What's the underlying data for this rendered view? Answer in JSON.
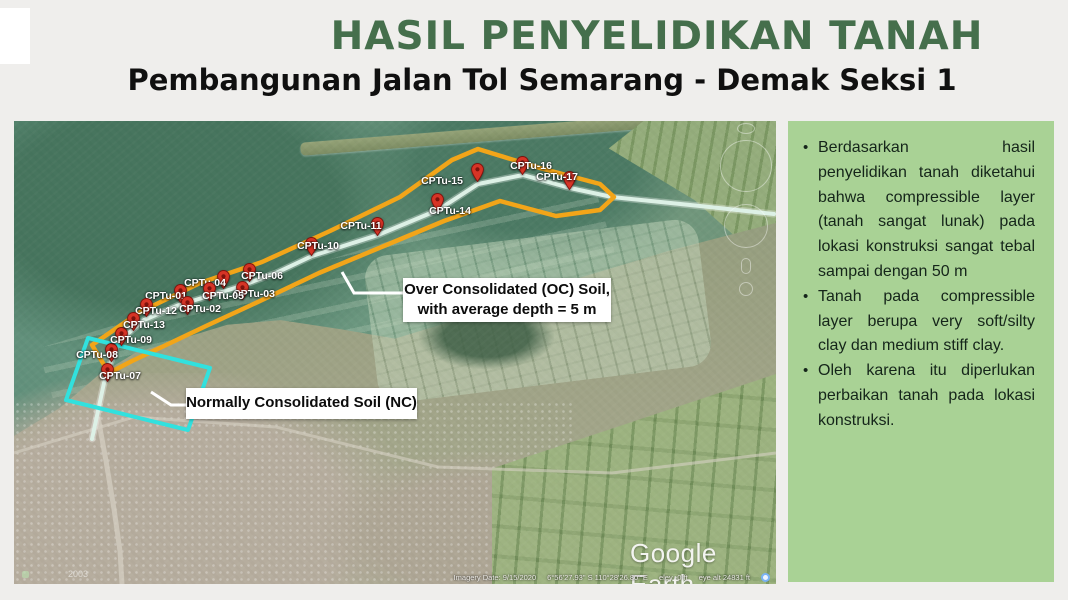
{
  "header": {
    "title": "HASIL PENYELIDIKAN TANAH",
    "subtitle": "Pembangunan Jalan Tol Semarang - Demak Seksi 1"
  },
  "panel": {
    "bullets": [
      "Berdasarkan hasil penyelidikan tanah diketahui bahwa compressible layer (tanah sangat lunak) pada lokasi konstruksi sangat tebal sampai dengan 50 m",
      "Tanah pada compressible layer berupa very soft/silty clay dan medium stiff clay.",
      "Oleh karena itu diperlukan perbaikan tanah pada lokasi konstruksi."
    ]
  },
  "map": {
    "oc_label": [
      "Over Consolidated (OC) Soil,",
      "with average depth = 5 m"
    ],
    "nc_label": "Normally Consolidated Soil (NC)",
    "watermark": "Google Earth",
    "status": {
      "imagery_date": "Imagery Date: 9/15/2020",
      "coordinates": "6°56'27.93\" S  110°28'26.80\" E",
      "elevation": "elev  -0 ft",
      "eye_altitude": "eye alt  24831 ft"
    },
    "history_year": "2003",
    "cpt_points": [
      {
        "id": "CPTu-01",
        "pin": [
          166,
          181
        ],
        "label": [
          152,
          175
        ]
      },
      {
        "id": "CPTu-02",
        "pin": [
          173,
          193
        ],
        "label": [
          186,
          188
        ]
      },
      {
        "id": "CPTu-03",
        "pin": [
          228,
          178
        ],
        "label": [
          240,
          173
        ]
      },
      {
        "id": "CPTu-04",
        "pin": [
          209,
          167
        ],
        "label": [
          191,
          162
        ]
      },
      {
        "id": "CPTu-05",
        "pin": [
          195,
          179
        ],
        "label": [
          209,
          175
        ]
      },
      {
        "id": "CPTu-06",
        "pin": [
          235,
          160
        ],
        "label": [
          248,
          155
        ]
      },
      {
        "id": "CPTu-07",
        "pin": [
          93,
          260
        ],
        "label": [
          106,
          255
        ]
      },
      {
        "id": "CPTu-08",
        "pin": [
          97,
          240
        ],
        "label": [
          83,
          234
        ]
      },
      {
        "id": "CPTu-09",
        "pin": [
          107,
          224
        ],
        "label": [
          117,
          219
        ]
      },
      {
        "id": "CPTu-12",
        "pin": [
          132,
          195
        ],
        "label": [
          142,
          190
        ]
      },
      {
        "id": "CPTu-13",
        "pin": [
          119,
          209
        ],
        "label": [
          130,
          204
        ]
      },
      {
        "id": "CPTu-10",
        "pin": [
          297,
          134
        ],
        "label": [
          304,
          125
        ]
      },
      {
        "id": "CPTu-11",
        "pin": [
          363,
          114
        ],
        "label": [
          347,
          105
        ]
      },
      {
        "id": "CPTu-14",
        "pin": [
          423,
          90
        ],
        "label": [
          436,
          90
        ]
      },
      {
        "id": "CPTu-15",
        "pin": [
          463,
          60
        ],
        "label": [
          428,
          60
        ]
      },
      {
        "id": "CPTu-16",
        "pin": [
          508,
          53
        ],
        "label": [
          517,
          45
        ]
      },
      {
        "id": "CPTu-17",
        "pin": [
          555,
          68
        ],
        "label": [
          543,
          56
        ]
      }
    ]
  },
  "colors": {
    "title_green": "#456f4c",
    "panel_green": "#a9d295",
    "pin_red": "#d63426",
    "oc_orange": "#f2a519",
    "nc_cyan": "#31e1de",
    "route_line": "#ddf1e6"
  }
}
